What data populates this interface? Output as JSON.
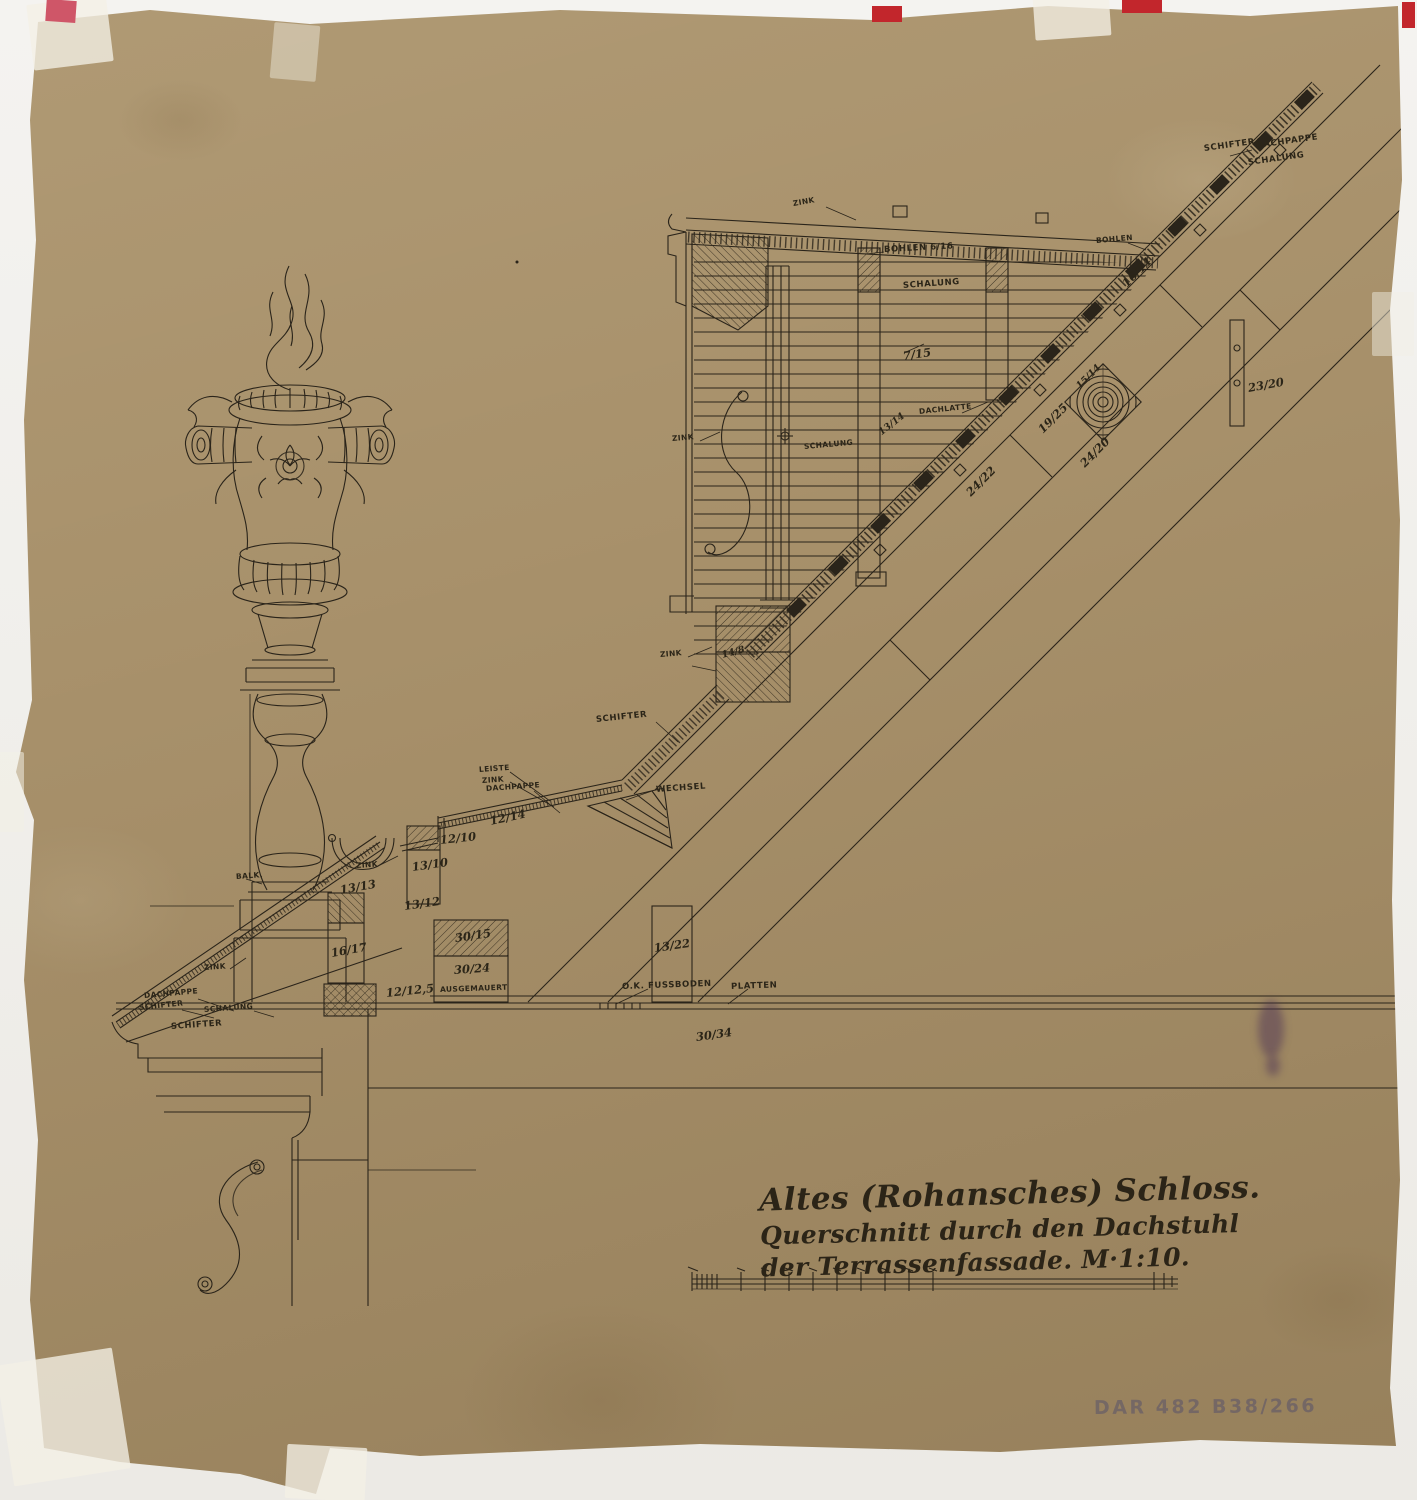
{
  "document": {
    "title_lines": [
      "Altes (Rohansches) Schloss.",
      "Querschnitt durch den Dachstuhl",
      "der Terrassenfassade. M·1:10."
    ],
    "archive_stamp": "DAR 482 B38/266"
  },
  "colors": {
    "paper": "#a7906a",
    "ink": "#2a241a",
    "tape": "#f3f0e5",
    "registration_red": "#c2262c",
    "stamp_blue": "#373a6e"
  },
  "labels": [
    "SCHIFTER",
    "DACHPAPPE",
    "SCHALUNG",
    "ZINK",
    "BOHLEN 6/16",
    "BOHLEN",
    "SCHALUNG",
    "7/15",
    "16/14",
    "DACHLATTE",
    "13/14",
    "SCHALUNG",
    "ZINK",
    "19/25",
    "24/22",
    "24/20",
    "15/14",
    "23/20",
    "ZINK",
    "14/8",
    "SCHIFTER",
    "LEISTE",
    "ZINK",
    "DACHPAPPE",
    "WECHSEL",
    "12/14",
    "12/10",
    "13/10",
    "ZINK",
    "13/13",
    "13/12",
    "30/15",
    "30/24",
    "AUSGEMAUERT",
    "16/17",
    "12/12,5",
    "13/22",
    "O.K. FUSSBODEN",
    "PLATTEN",
    "30/34",
    "ZINK",
    "DACHPAPPE",
    "SCHIFTER",
    "SCHALUNG",
    "SCHIFTER",
    "BALK."
  ]
}
